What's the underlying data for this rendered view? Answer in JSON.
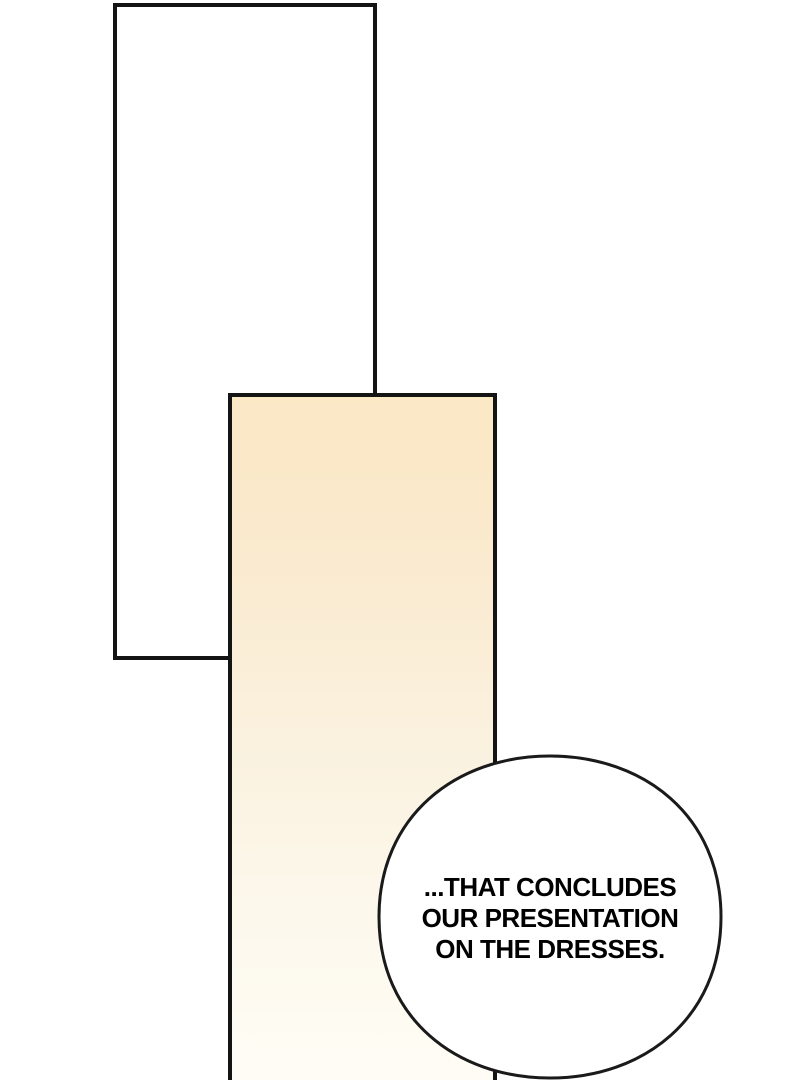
{
  "page": {
    "background_color": "#ffffff",
    "panel_border_color": "#141414"
  },
  "panels": [
    {
      "id": "panel-top-left",
      "fill": "#ffffff"
    },
    {
      "id": "panel-center",
      "fill_top": "#fbe8c5",
      "fill_bottom": "#fffdf6"
    }
  ],
  "speech_bubble": {
    "fill": "#ffffff",
    "border_color": "#1a1a1a",
    "text_color": "#000000",
    "lines": [
      "...THAT CONCLUDES",
      "OUR PRESENTATION",
      "ON THE DRESSES."
    ]
  }
}
